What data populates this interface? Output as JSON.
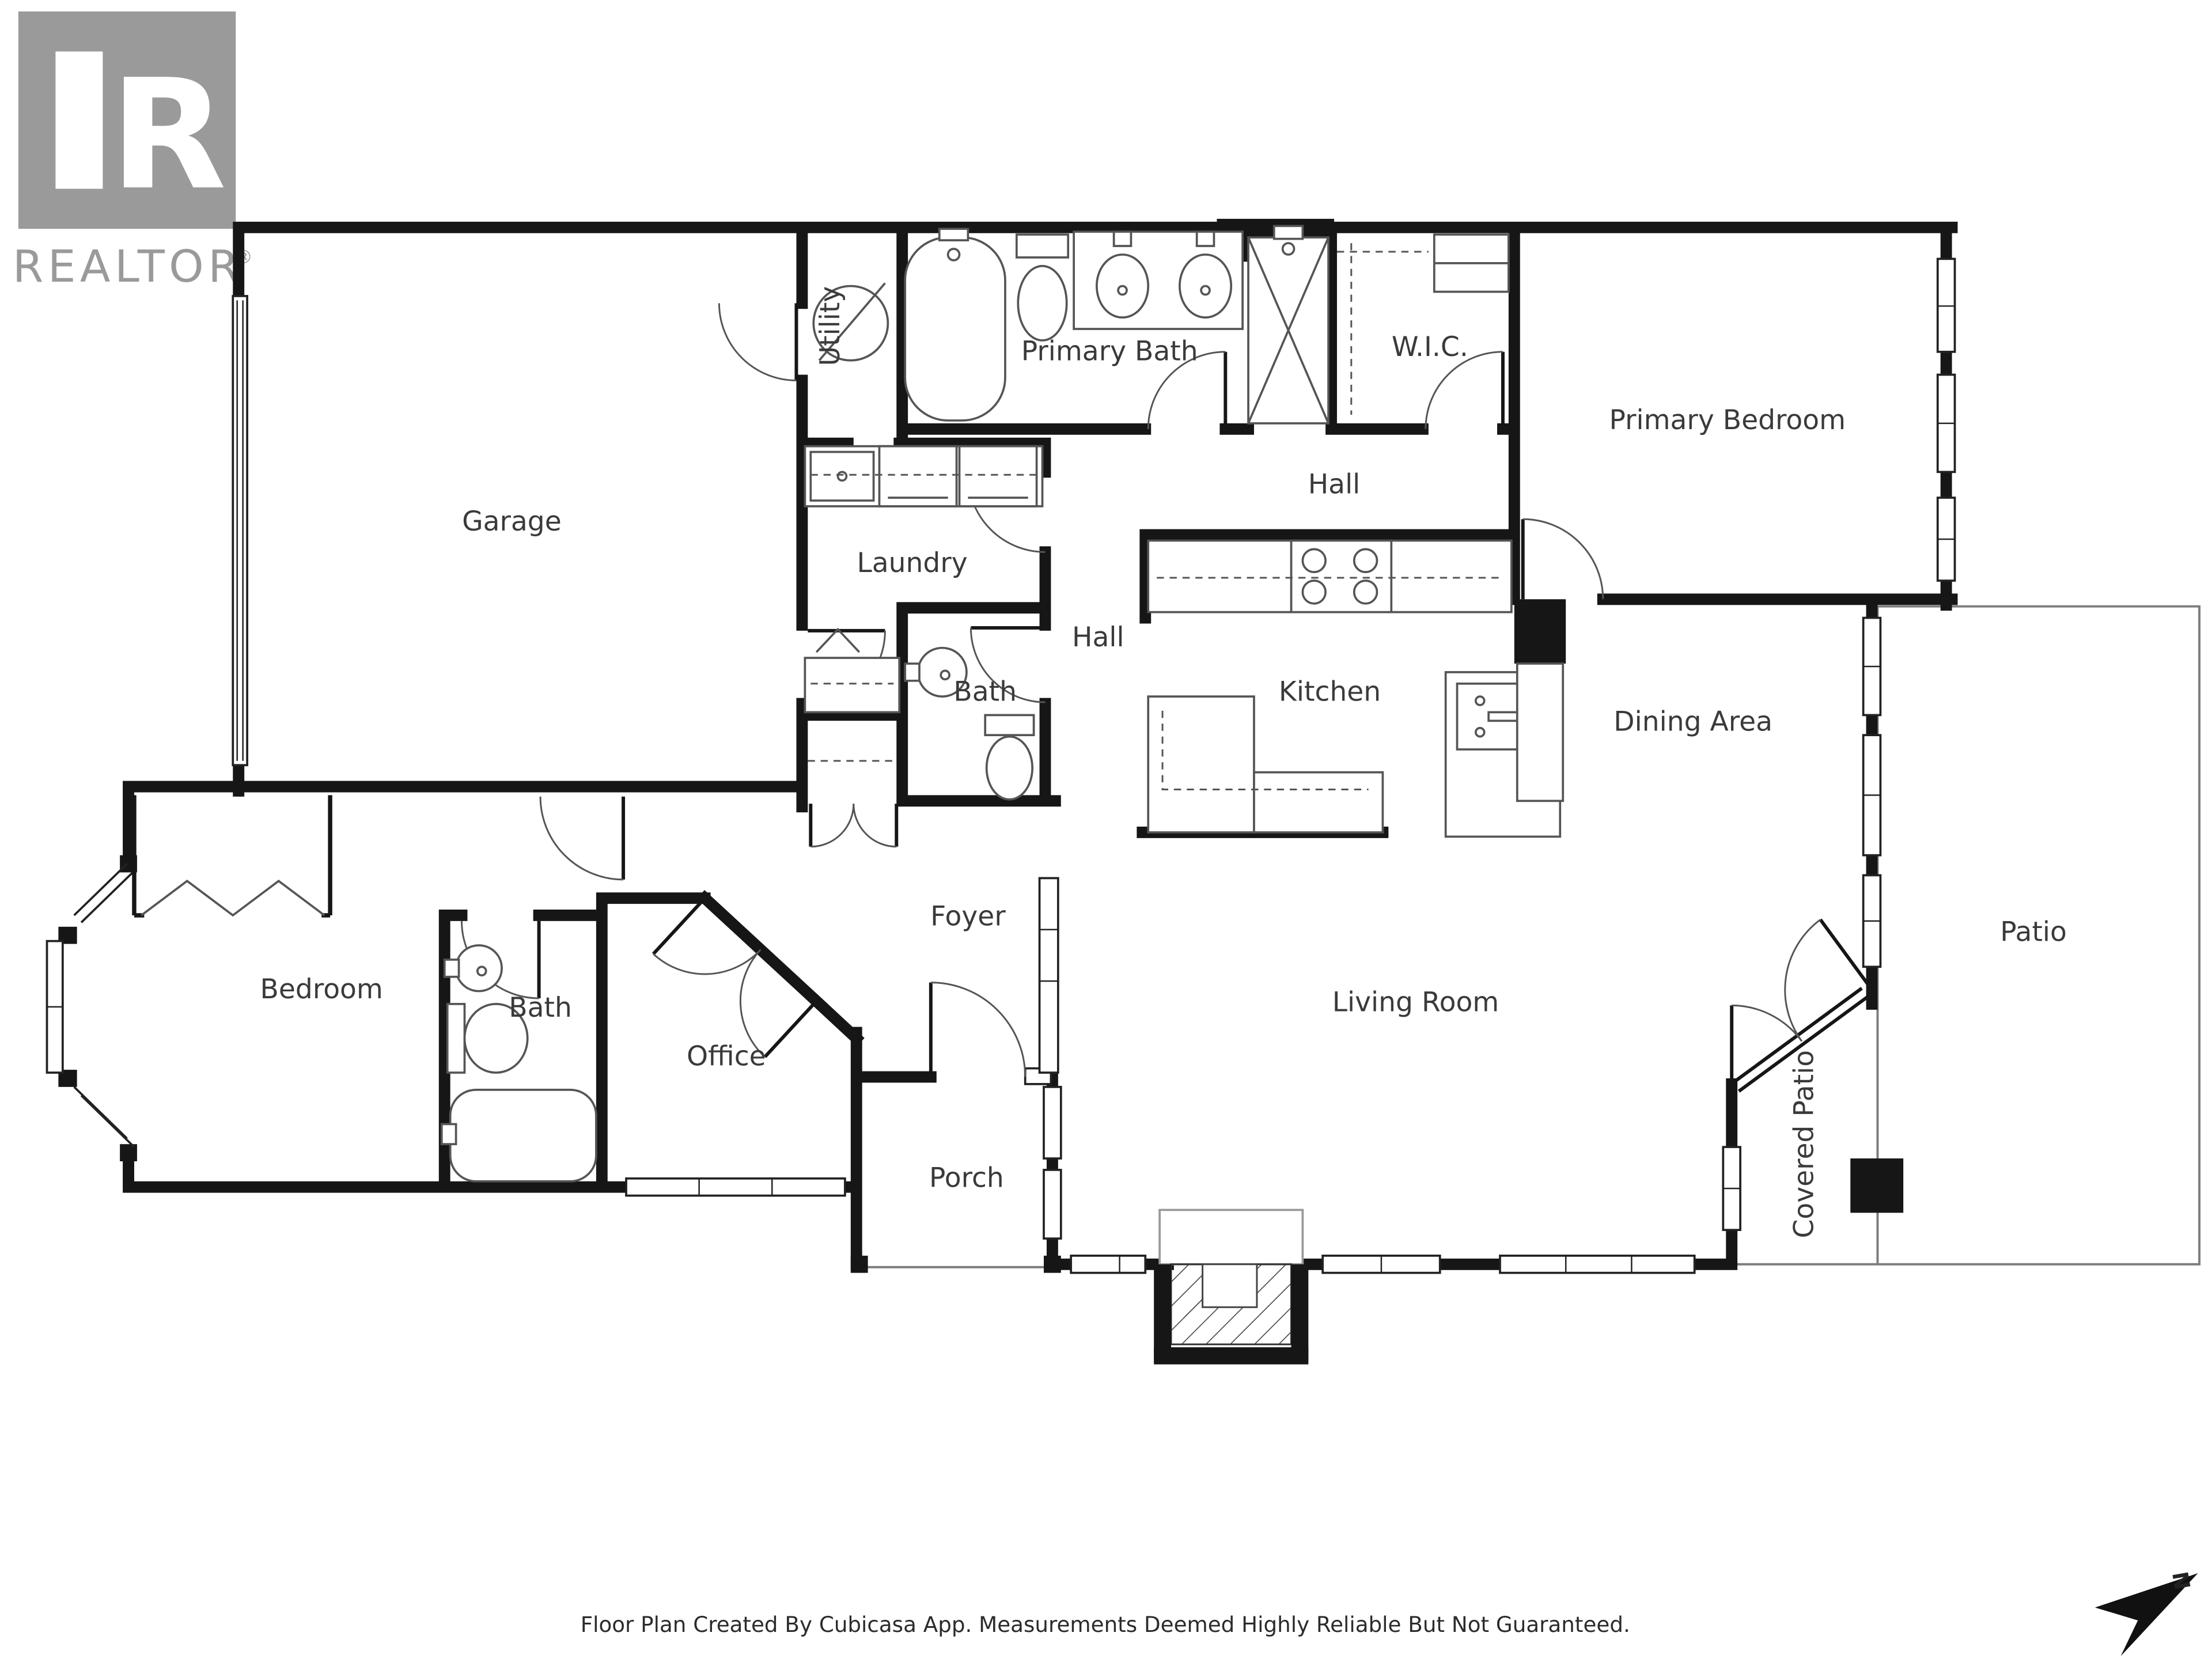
{
  "branding": {
    "logo_text": "REALTOR",
    "registered_mark": "®"
  },
  "rooms": {
    "garage": "Garage",
    "utility": "Utility",
    "primary_bath": "Primary Bath",
    "wic": "W.I.C.",
    "primary_bedroom": "Primary Bedroom",
    "hall_upper": "Hall",
    "laundry": "Laundry",
    "hall_center": "Hall",
    "bath_upper": "Bath",
    "kitchen": "Kitchen",
    "dining_area": "Dining Area",
    "foyer": "Foyer",
    "living_room": "Living Room",
    "bedroom": "Bedroom",
    "bath_lower": "Bath",
    "office": "Office",
    "porch": "Porch",
    "patio": "Patio",
    "covered_patio": "Covered Patio"
  },
  "compass": {
    "north_label": "N"
  },
  "footer": {
    "disclaimer": "Floor Plan Created By Cubicasa App. Measurements Deemed Highly Reliable But Not Guaranteed."
  },
  "colors": {
    "wall": "#161616",
    "label": "#3a3a3a",
    "logo_gray": "#9a9a9a",
    "fixture": "#555555"
  }
}
